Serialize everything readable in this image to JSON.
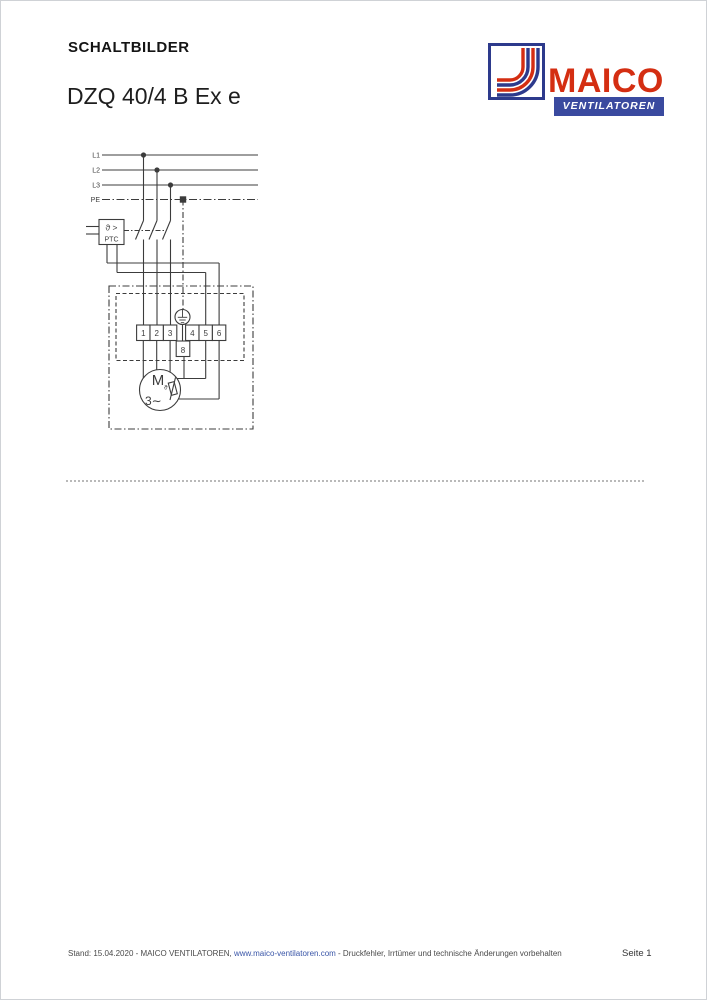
{
  "header": {
    "section_title": "SCHALTBILDER",
    "product_title": "DZQ 40/4 B Ex e"
  },
  "logo": {
    "brand": "MAICO",
    "tagline": "VENTILATOREN",
    "brand_red": "#d42e12",
    "brand_blue": "#2d3a8c"
  },
  "diagram": {
    "phases": [
      "L1",
      "L2",
      "L3",
      "PE"
    ],
    "ptc_relay": {
      "symbol": "ϑ >",
      "label": "PTC"
    },
    "terminals": [
      "1",
      "2",
      "3",
      "4",
      "5",
      "6"
    ],
    "earth_terminal": "8",
    "motor": {
      "label": "M",
      "phase_symbol": "3∼",
      "thermistor_symbol": "ϑ"
    }
  },
  "footer": {
    "stand_prefix": "Stand: 15.04.2020 - MAICO VENTILATOREN, ",
    "website": "www.maico-ventilatoren.com",
    "stand_suffix": " - Druckfehler, Irrtümer und technische Änderungen vorbehalten",
    "page_label": "Seite 1"
  }
}
